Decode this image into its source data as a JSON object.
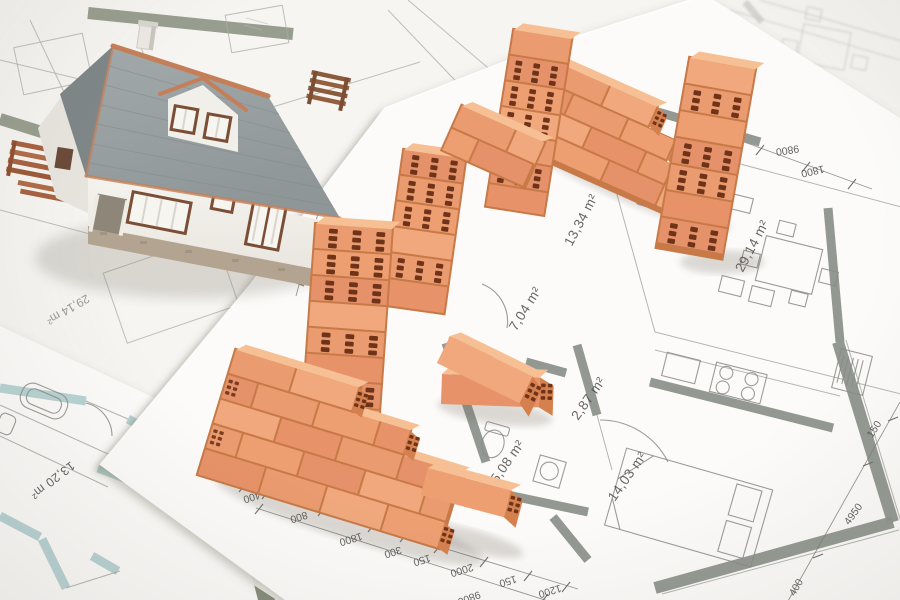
{
  "scene": {
    "description": "Photograph of a miniature model house and toy clay bricks forming walls, arranged on top of layered architectural floor plan blueprints",
    "colors": {
      "paper": "#fcfbf9",
      "plan_wall_gray": "#8d948c",
      "plan_wall_olive": "#7a8270",
      "plan_wall_teal": "#b7d3d3",
      "plan_line": "#9d9d99",
      "label_text": "#4c4c4a",
      "brick_face": "#ea9b6f",
      "brick_top": "#f6c094",
      "brick_end": "#d5804f",
      "brick_hole": "#6f3319",
      "roof_gray": "#9aa1a3",
      "roof_ridge_terracotta": "#c57f58",
      "house_wall": "#f3f1ec",
      "house_base_stone": "#b3a492",
      "balcony_wood": "#a8613f"
    }
  },
  "blueprint": {
    "room_labels": [
      {
        "text": "13,34 m²"
      },
      {
        "text": "29,14 m²"
      },
      {
        "text": "7,04 m²"
      },
      {
        "text": "2,87 m²"
      },
      {
        "text": "5,08 m²"
      },
      {
        "text": "14,03 m²"
      },
      {
        "text": "13,20 m²"
      },
      {
        "text": "29,14 m²"
      }
    ],
    "dimensions": {
      "bottom_chain": [
        "400",
        "800",
        "1800",
        "300",
        "150",
        "2000",
        "150",
        "1200"
      ],
      "bottom_total": "9800",
      "right_chain": [
        "150",
        "4950",
        "400"
      ],
      "left_chain": [
        "400",
        "2100"
      ],
      "top_chain": [
        "9800",
        "1800"
      ]
    }
  }
}
